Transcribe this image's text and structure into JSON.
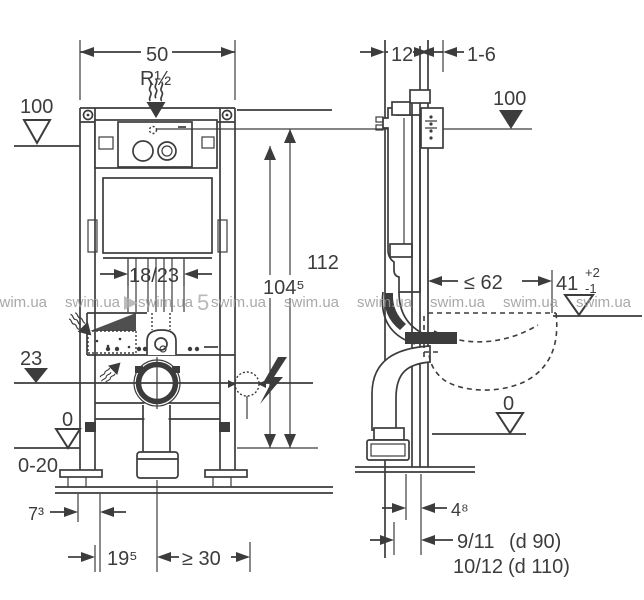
{
  "front": {
    "width": "50",
    "thread": "R½",
    "level_top": "100",
    "plate_span": "18/23",
    "level_outlet": "23",
    "level_floor": "0",
    "foot_adjust": "0-20",
    "height_total": "112",
    "height_plate": "104⁵",
    "foot_offset": "7³",
    "outlet_center": "19⁵",
    "min_clearance": "≥ 30"
  },
  "side": {
    "frame_depth": "12",
    "wall_finish": "1-6",
    "level_top": "100",
    "bowl_depth": "≤ 62",
    "seat_height": "41",
    "seat_tol_plus": "+2",
    "seat_tol_minus": "-1",
    "level_floor": "0",
    "outlet_offset": "4⁸",
    "outlet_a": "9/11",
    "outlet_a_dia": "(d 90)",
    "outlet_b": "10/12",
    "outlet_b_dia": "(d 110)"
  },
  "watermark": {
    "text": "swim.ua",
    "digit": "5"
  },
  "colors": {
    "line": "#3c3c3c",
    "watermark": "#9a9a9a"
  }
}
